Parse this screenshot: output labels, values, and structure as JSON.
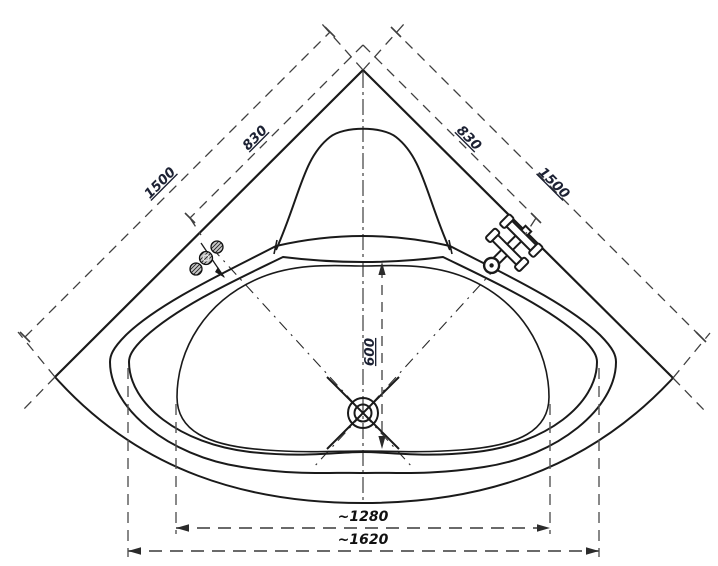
{
  "drawing": {
    "type": "technical-plan",
    "subject": "corner bathtub top view with dimensions",
    "dimensions": {
      "left_wall_total": "1500",
      "left_wall_segment": "830",
      "right_wall_segment": "830",
      "right_wall_total": "1500",
      "basin_interior_depth": "600",
      "basin_width": "~1280",
      "rim_width": "~1620"
    },
    "colors": {
      "background": "#ffffff",
      "outline": "#1a1a1a",
      "dimension_lines": "#4a4a4a",
      "labels": "#1c2133"
    },
    "icons": [
      "drain-icon",
      "faucet-icon",
      "jet-knobs-icon"
    ]
  }
}
